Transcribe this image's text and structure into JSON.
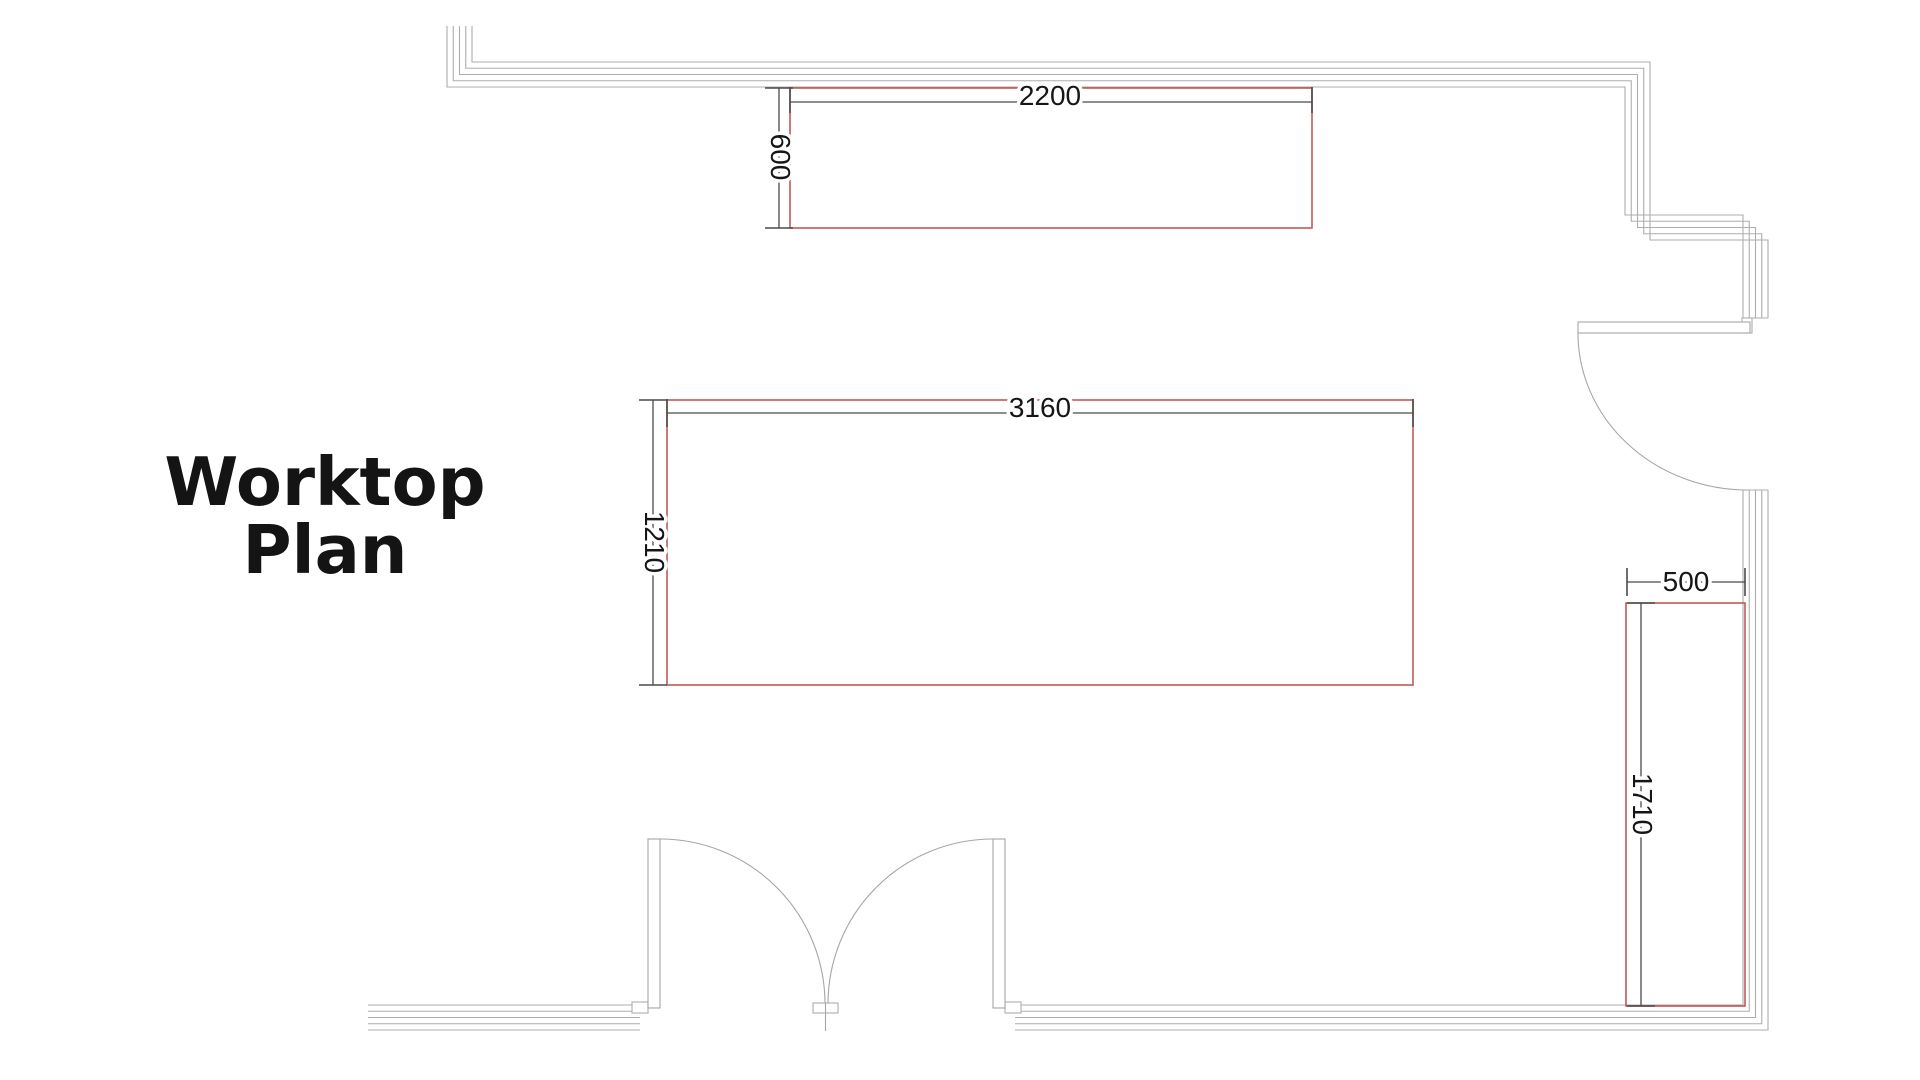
{
  "title": {
    "line1": "Worktop",
    "line2": "Plan"
  },
  "colors": {
    "background": "#ffffff",
    "title_text": "#141414",
    "worktop_outline": "#bf4f4b",
    "dimension_line": "#4a4a4a",
    "dimension_text": "#161616",
    "wall_line": "#adadad",
    "door_line": "#a6a6a6"
  },
  "worktops": [
    {
      "name": "wall-worktop-top",
      "width_mm": 2200,
      "depth_mm": 600,
      "width_label": "2200",
      "depth_label": "600"
    },
    {
      "name": "island-worktop",
      "width_mm": 3160,
      "depth_mm": 1210,
      "width_label": "3160",
      "depth_label": "1210"
    },
    {
      "name": "side-worktop-right",
      "width_mm": 500,
      "depth_mm": 1710,
      "width_label": "500",
      "depth_label": "1710"
    }
  ],
  "doors": [
    {
      "type": "double-swing-door",
      "location": "bottom-wall"
    },
    {
      "type": "single-swing-door",
      "location": "right-wall"
    }
  ]
}
